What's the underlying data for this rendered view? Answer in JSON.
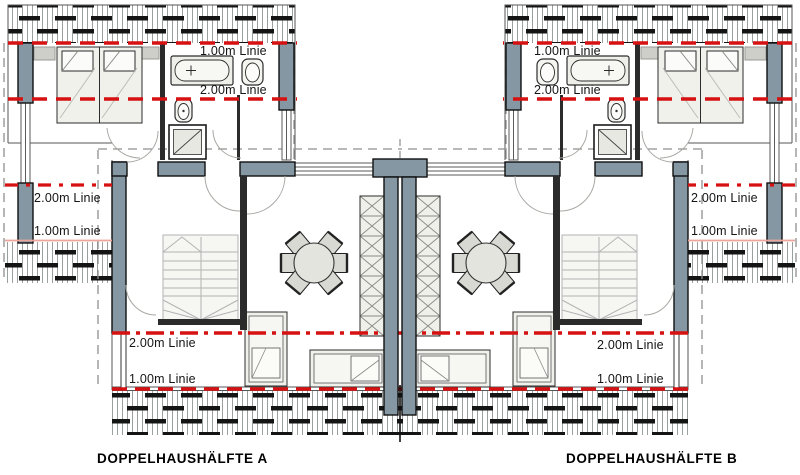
{
  "plan": {
    "house_a": {
      "title": "DOPPELHAUSHÄLFTE A"
    },
    "house_b": {
      "title": "DOPPELHAUSHÄLFTE B"
    },
    "height_lines": {
      "top_a": {
        "one_m": "1.00m Linie",
        "two_m": "2.00m Linie"
      },
      "top_b": {
        "one_m": "1.00m Linie",
        "two_m": "2.00m Linie"
      },
      "left": {
        "one_m": "1.00m Linie",
        "two_m": "2.00m Linie"
      },
      "right": {
        "one_m": "1.00m Linie",
        "two_m": "2.00m Linie"
      },
      "bottom_a": {
        "one_m": "1.00m Linie",
        "two_m": "2.00m Linie"
      },
      "bottom_b": {
        "one_m": "1.00m Linie",
        "two_m": "2.00m Linie"
      }
    },
    "colors": {
      "height_line_red": "#d61111",
      "height_line_pale": "#eda49a",
      "wall_fill": "#8497a3",
      "paper": "#ffffff"
    }
  }
}
